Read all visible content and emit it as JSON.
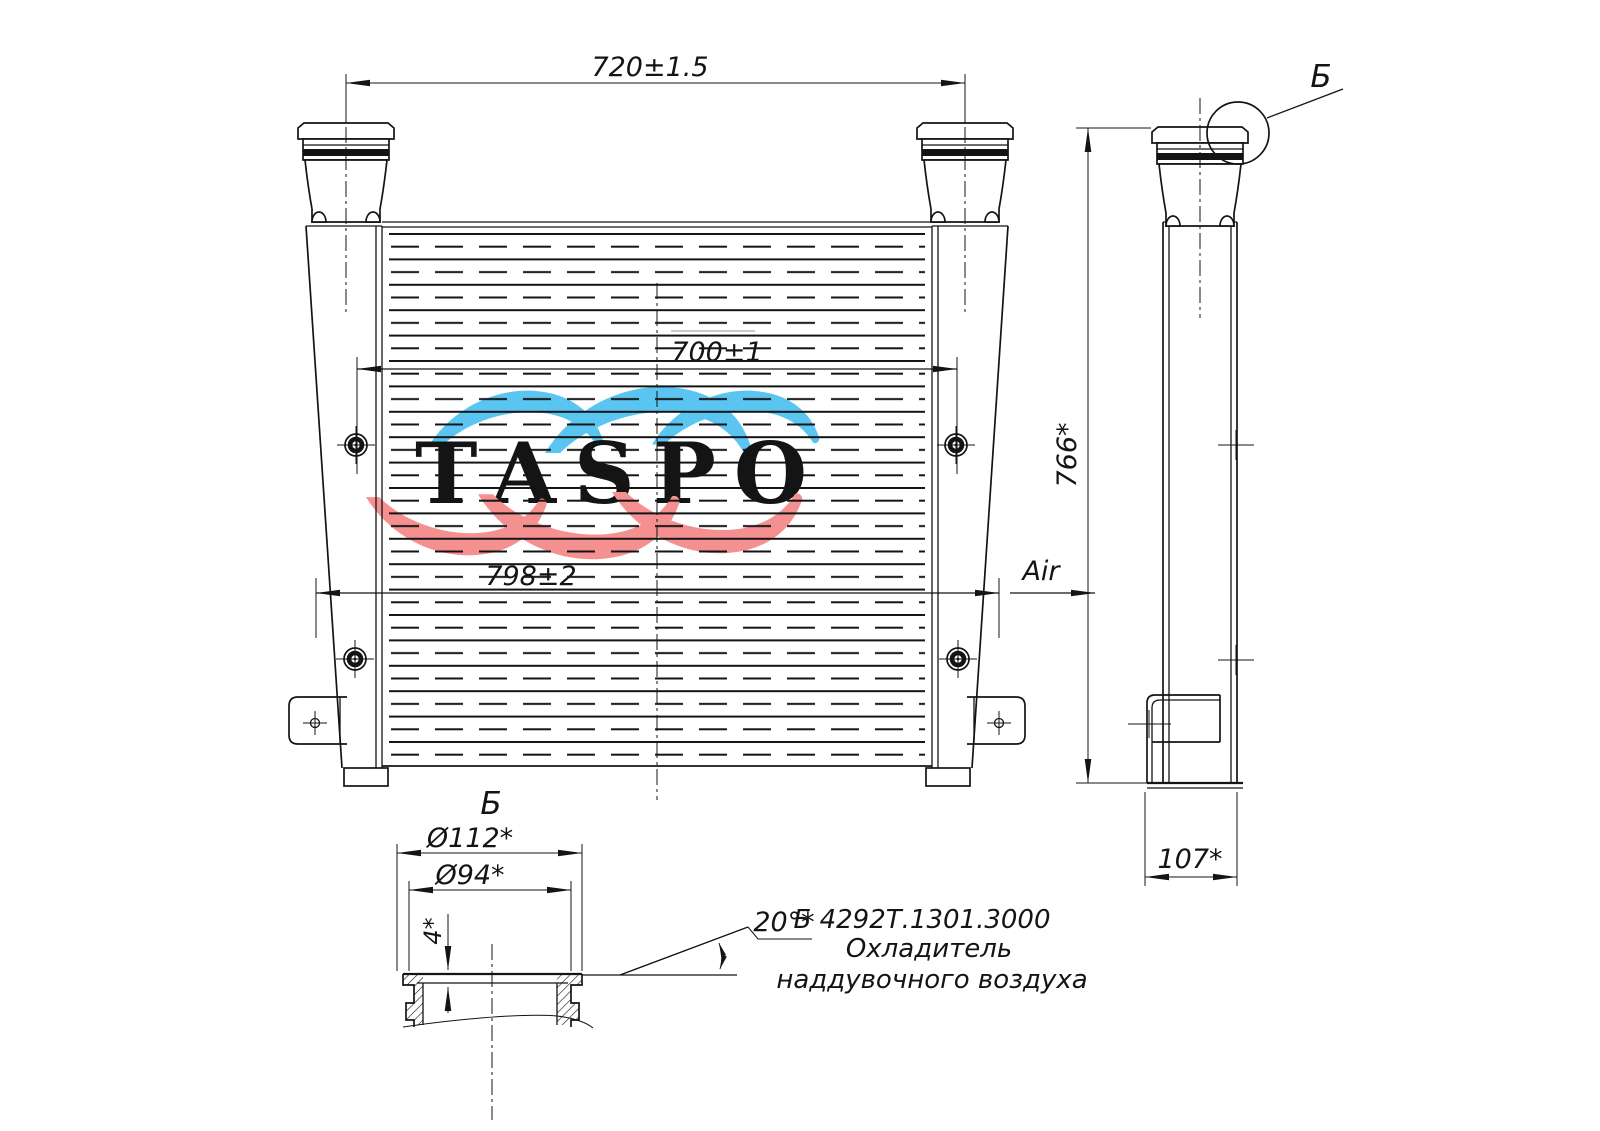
{
  "drawing": {
    "kind": "charge air cooler technical drawing"
  },
  "dimensions": {
    "top_width": "720±1.5",
    "core_width": "700±1",
    "overall_width": "798±2",
    "overall_height": "766*",
    "depth": "107*",
    "flange_outer_dia": "Ø112*",
    "flange_bore_dia": "Ø94*",
    "flange_lip_height": "4*",
    "flange_angle": "20°*"
  },
  "labels": {
    "detail_callout": "Б",
    "detail_view": "Б",
    "air": "Air"
  },
  "part": {
    "code": "Б 4292Т.1301.3000",
    "name_line1": "Охладитель",
    "name_line2": "наддувочного воздуха"
  },
  "watermark": {
    "text": "TASPO",
    "colors": {
      "blue": "#5bc5f2",
      "gray": "#9c9c9c",
      "red": "#f59090"
    }
  }
}
